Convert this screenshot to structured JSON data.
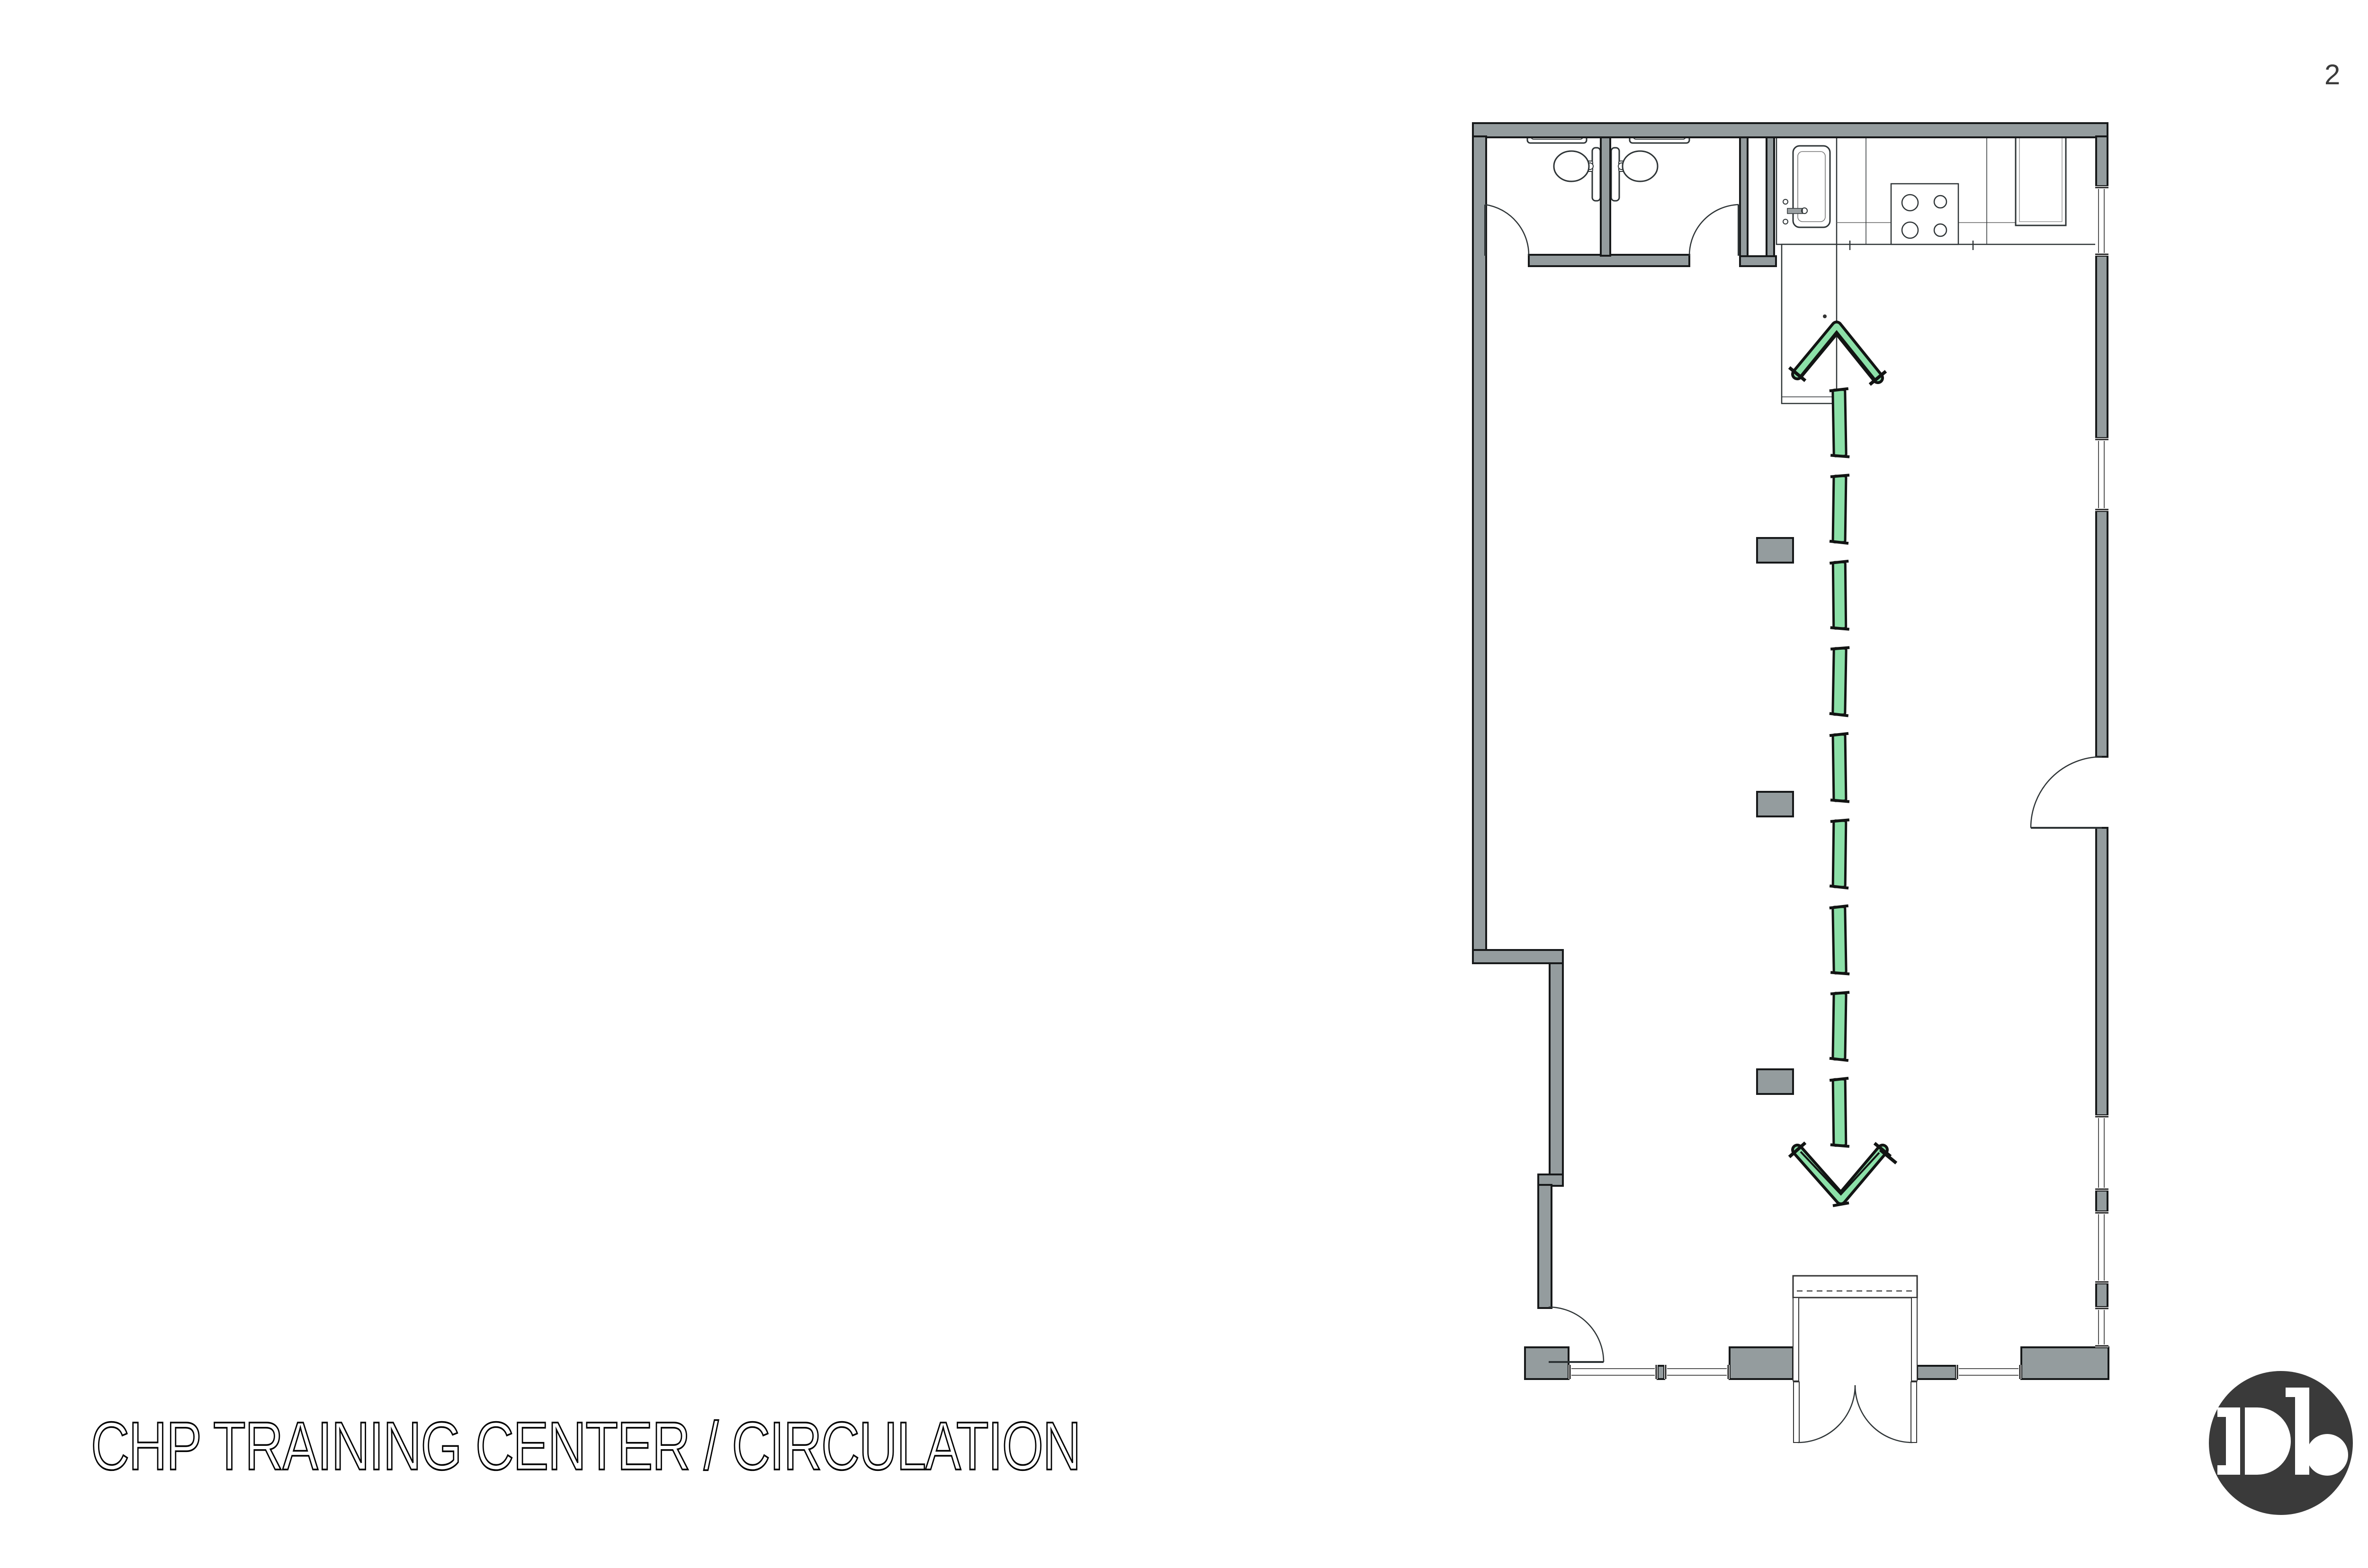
{
  "page": {
    "number": "2"
  },
  "footer": {
    "title": "CHP TRAINING CENTER / CIRCULATION"
  },
  "logo": {
    "monogram": "Db"
  },
  "colors": {
    "background": "#ffffff",
    "wall_fill": "#949c9e",
    "wall_outline": "#17191a",
    "fixture_line": "#2e3436",
    "window_line": "#555555",
    "arrow_green": "#8ce0a8",
    "arrow_ink": "#121413",
    "page_text": "#3b3b3b",
    "logo_bg": "#3a3a3a"
  },
  "plan": {
    "name": "floor-plan",
    "arrow": {
      "name": "circulation-arrow",
      "style": "hand-drawn dashed",
      "direction": "bidirectional-vertical",
      "dash_count": 9
    }
  }
}
